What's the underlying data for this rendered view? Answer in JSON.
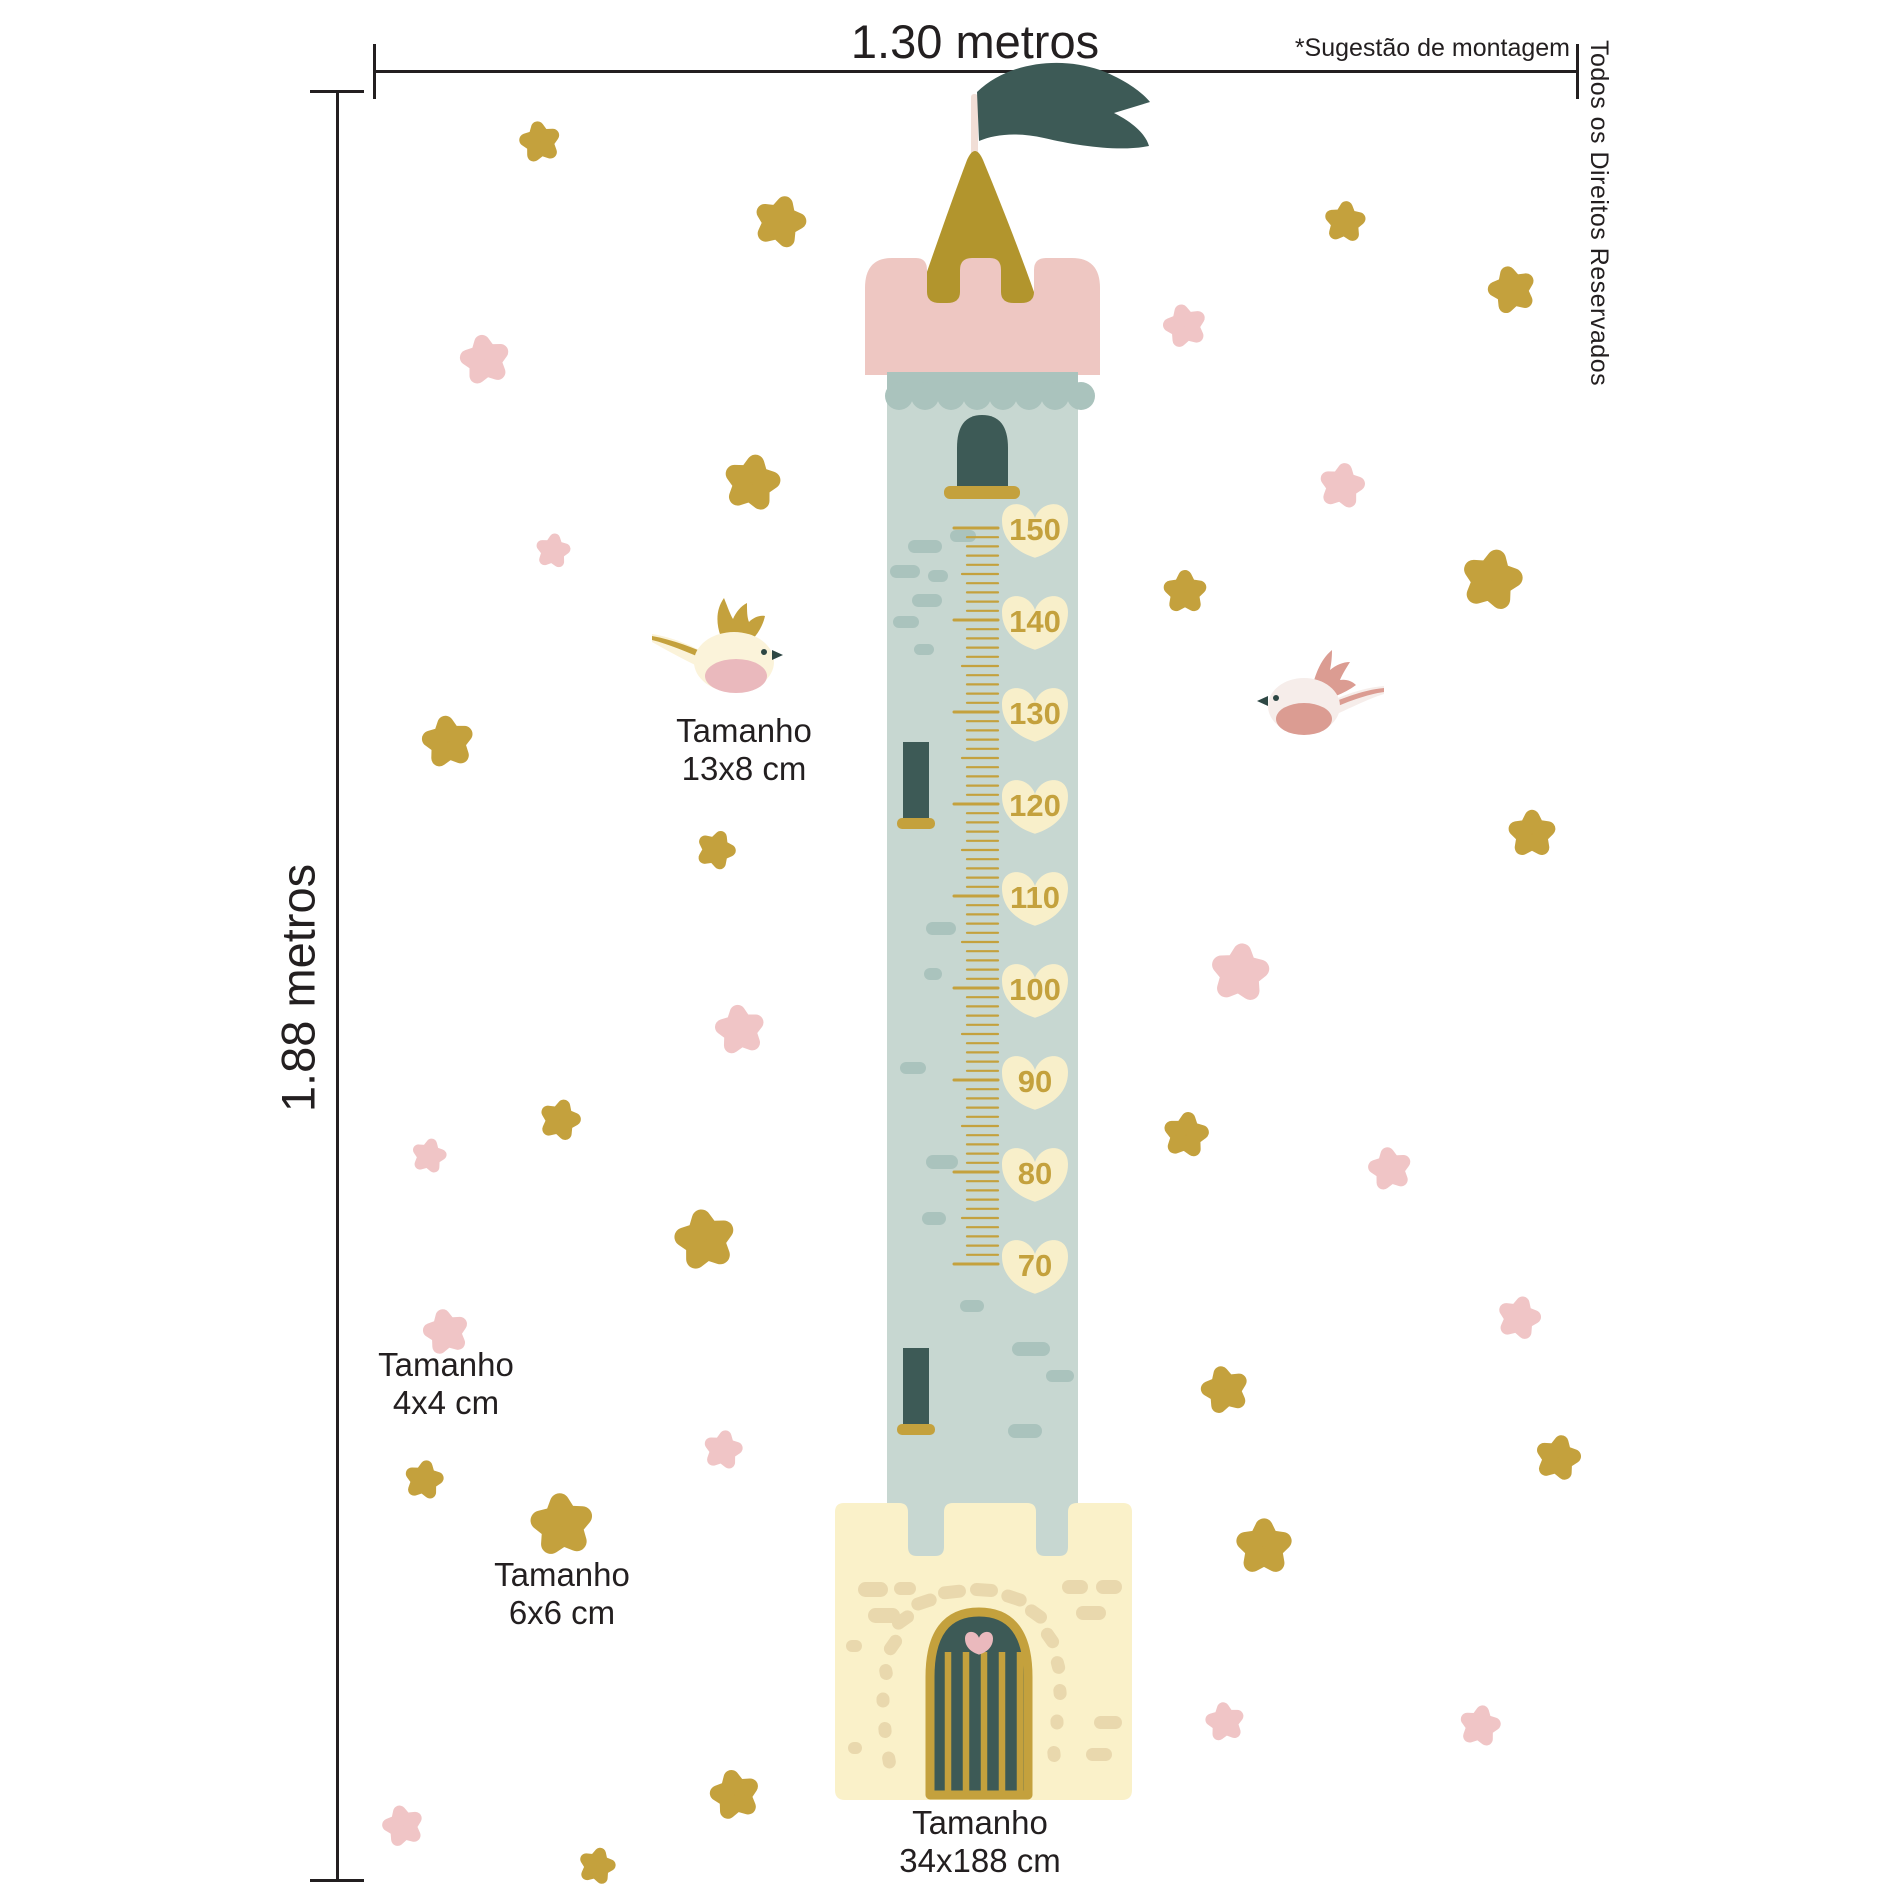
{
  "annotations": {
    "width_label": "1.30 metros",
    "height_label": "1.88 metros",
    "mounting_note": "*Sugestão de montagem",
    "rights_notice": "Todos os Direitos Reservados",
    "size_labels": {
      "bird": {
        "title": "Tamanho",
        "value": "13x8 cm"
      },
      "small_star": {
        "title": "Tamanho",
        "value": "4x4 cm"
      },
      "large_star": {
        "title": "Tamanho",
        "value": "6x6 cm"
      },
      "tower": {
        "title": "Tamanho",
        "value": "34x188 cm"
      }
    }
  },
  "growth_chart": {
    "unit": "cm",
    "values": [
      150,
      140,
      130,
      120,
      110,
      100,
      90,
      80,
      70
    ],
    "top_value_y": 528,
    "step_px": 92,
    "tick_px_per_cm": 9.2
  },
  "colors": {
    "ink": "#231f20",
    "gold": "#c4a13d",
    "mustard_roof": "#b2952d",
    "pink": "#f0c5c6",
    "pink_turret": "#eec7c2",
    "teal_dark": "#3d5a56",
    "tower_blue": "#c7d7d1",
    "tower_brick": "#aac3bd",
    "base_cream": "#faf1c9",
    "base_stone": "#e9d8ad",
    "heart_cream": "#f8efca",
    "pole_cream": "#f1ded6",
    "bird_cream": "#fbf3da",
    "bird_pink_body": "#f6edea",
    "bird_pink_accent": "#db9c92",
    "belly_pink": "#eab9bd",
    "eye_dark": "#2e4744"
  },
  "artwork": {
    "gold_stars": [
      [
        540,
        142,
        38,
        -10
      ],
      [
        780,
        222,
        48,
        15
      ],
      [
        1345,
        222,
        38,
        5
      ],
      [
        1512,
        290,
        44,
        -15
      ],
      [
        752,
        483,
        52,
        10
      ],
      [
        1185,
        592,
        40,
        0
      ],
      [
        1492,
        580,
        56,
        12
      ],
      [
        448,
        742,
        48,
        -8
      ],
      [
        716,
        850,
        36,
        20
      ],
      [
        1532,
        834,
        44,
        0
      ],
      [
        560,
        1120,
        38,
        15
      ],
      [
        705,
        1240,
        56,
        -10
      ],
      [
        1186,
        1135,
        42,
        8
      ],
      [
        1225,
        1390,
        44,
        -14
      ],
      [
        424,
        1480,
        36,
        10
      ],
      [
        562,
        1525,
        58,
        -6
      ],
      [
        1558,
        1458,
        42,
        12
      ],
      [
        1264,
        1547,
        52,
        0
      ],
      [
        735,
        1795,
        46,
        -12
      ],
      [
        597,
        1866,
        34,
        14
      ]
    ],
    "pink_stars": [
      [
        485,
        360,
        46,
        -10
      ],
      [
        553,
        551,
        32,
        8
      ],
      [
        1185,
        326,
        40,
        -14
      ],
      [
        1342,
        486,
        42,
        10
      ],
      [
        740,
        1030,
        46,
        -8
      ],
      [
        429,
        1156,
        32,
        12
      ],
      [
        1390,
        1169,
        40,
        -10
      ],
      [
        1240,
        973,
        54,
        6
      ],
      [
        446,
        1332,
        42,
        -12
      ],
      [
        723,
        1450,
        36,
        10
      ],
      [
        1519,
        1318,
        40,
        14
      ],
      [
        1225,
        1722,
        36,
        -8
      ],
      [
        1480,
        1726,
        38,
        10
      ],
      [
        403,
        1826,
        38,
        -14
      ]
    ],
    "bricks": [
      [
        908,
        540,
        34,
        13
      ],
      [
        950,
        530,
        26,
        12
      ],
      [
        890,
        565,
        30,
        13
      ],
      [
        928,
        570,
        20,
        12
      ],
      [
        912,
        594,
        30,
        13
      ],
      [
        893,
        616,
        26,
        12
      ],
      [
        914,
        644,
        20,
        11
      ],
      [
        926,
        922,
        30,
        13
      ],
      [
        924,
        968,
        18,
        12
      ],
      [
        900,
        1062,
        26,
        12
      ],
      [
        926,
        1155,
        32,
        14
      ],
      [
        922,
        1212,
        24,
        13
      ],
      [
        1012,
        1342,
        38,
        14
      ],
      [
        1046,
        1370,
        28,
        12
      ],
      [
        1008,
        1424,
        34,
        14
      ],
      [
        960,
        1300,
        24,
        12
      ]
    ],
    "stones_blocks": [
      [
        858,
        1582,
        30,
        15
      ],
      [
        894,
        1582,
        22,
        13
      ],
      [
        868,
        1608,
        32,
        15
      ],
      [
        1062,
        1580,
        26,
        14
      ],
      [
        1096,
        1580,
        26,
        14
      ],
      [
        1076,
        1606,
        30,
        14
      ],
      [
        1094,
        1716,
        28,
        13
      ],
      [
        1086,
        1748,
        26,
        13
      ],
      [
        846,
        1640,
        16,
        12
      ],
      [
        848,
        1742,
        14,
        12
      ]
    ],
    "stones_arch": [
      [
        893,
        1645,
        22,
        -55
      ],
      [
        903,
        1620,
        24,
        -35
      ],
      [
        924,
        1602,
        26,
        -18
      ],
      [
        952,
        1592,
        28,
        -6
      ],
      [
        984,
        1590,
        28,
        4
      ],
      [
        1014,
        1598,
        26,
        18
      ],
      [
        1036,
        1614,
        24,
        35
      ],
      [
        1050,
        1638,
        22,
        55
      ],
      [
        1058,
        1665,
        18,
        75
      ],
      [
        1060,
        1692,
        16,
        85
      ],
      [
        886,
        1672,
        16,
        80
      ],
      [
        883,
        1700,
        15,
        88
      ],
      [
        885,
        1730,
        16,
        85
      ],
      [
        889,
        1760,
        17,
        80
      ],
      [
        1057,
        1722,
        15,
        88
      ],
      [
        1054,
        1754,
        16,
        85
      ]
    ],
    "door_bars_x": [
      948,
      966,
      984,
      1002,
      1020
    ],
    "birds": {
      "gold": {
        "x": 720,
        "y": 660
      },
      "pink": {
        "x": 1312,
        "y": 706
      }
    }
  }
}
